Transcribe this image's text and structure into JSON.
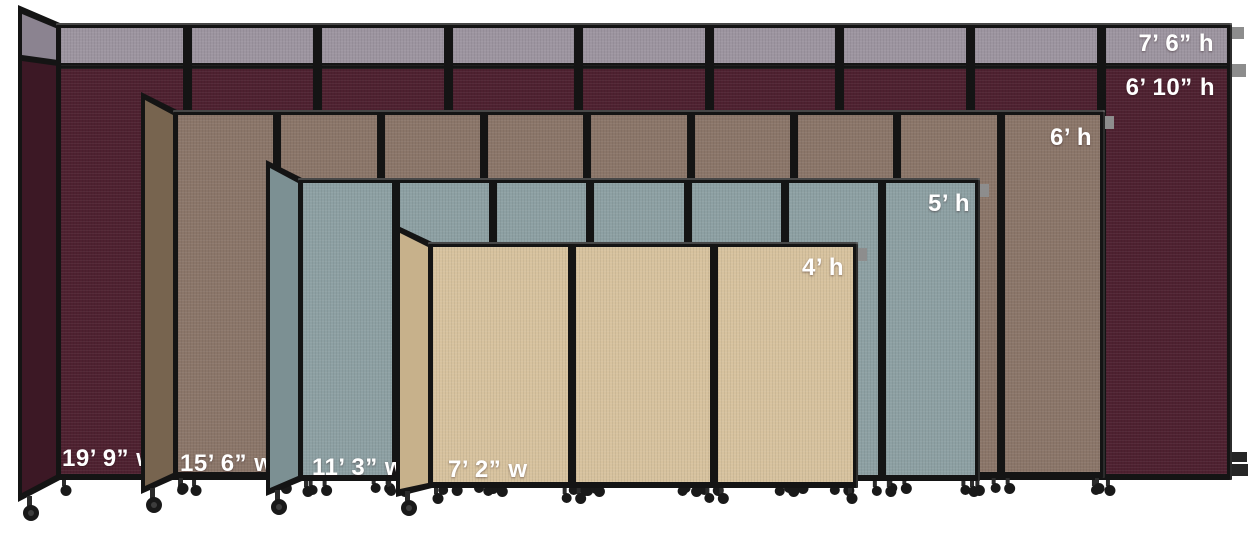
{
  "image": {
    "background_color": "#ffffff",
    "frame_color": "#141414",
    "bracket_color": "#8d8d8d",
    "caster_color": "#191919"
  },
  "dividers": [
    {
      "name": "cranberry",
      "panels": 9,
      "fabric": "#4e2130",
      "return_fabric": "#3c1825",
      "top_extender_fabric": "#9d95a0",
      "top_extender_return_fabric": "#8b8390",
      "extender_height_label": "7’ 6” h",
      "height_label": "6’ 10” h",
      "width_label": "19’ 9” w"
    },
    {
      "name": "mocha",
      "panels": 9,
      "fabric": "#8b7669",
      "return_fabric": "#77644f",
      "height_label": "6’ h",
      "width_label": "15’ 6” w"
    },
    {
      "name": "slate",
      "panels": 7,
      "fabric": "#8da0a3",
      "return_fabric": "#7c9093",
      "height_label": "5’ h",
      "width_label": "11’ 3” w"
    },
    {
      "name": "sand",
      "panels": 3,
      "fabric": "#d7c29e",
      "return_fabric": "#c7b18b",
      "height_label": "4’ h",
      "width_label": "7’ 2” w"
    }
  ]
}
